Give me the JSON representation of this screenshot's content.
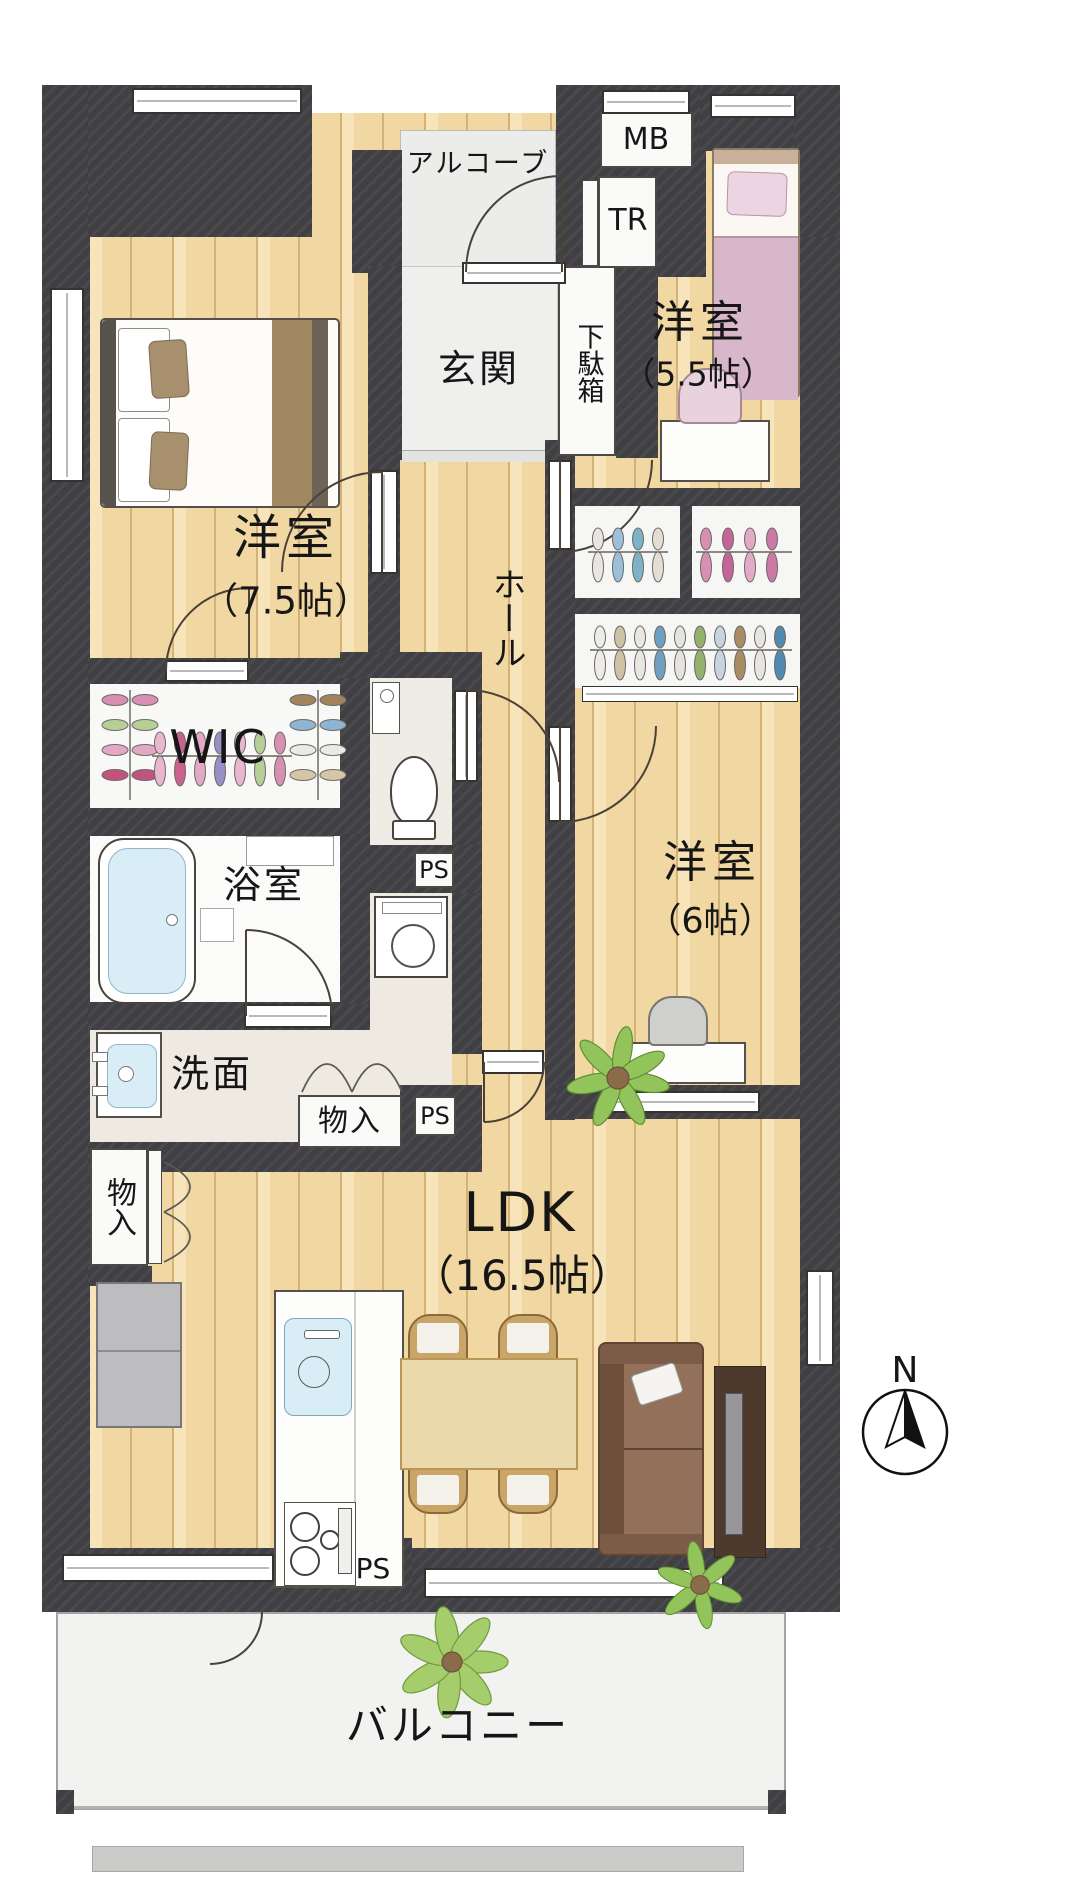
{
  "rooms": {
    "alcove": {
      "label": "アルコーブ"
    },
    "meter_box": {
      "label": "MB"
    },
    "trunk_room": {
      "label": "TR"
    },
    "entrance": {
      "label": "玄関"
    },
    "shoe_cabinet": {
      "label": "下駄箱"
    },
    "bedroom_75": {
      "label": "洋室",
      "size": "（7.5帖）"
    },
    "bedroom_55": {
      "label": "洋室",
      "size": "（5.5帖）"
    },
    "bedroom_6": {
      "label": "洋室",
      "size": "（6帖）"
    },
    "hall": {
      "label": "ホール"
    },
    "wic": {
      "label": "WIC"
    },
    "bathroom": {
      "label": "浴室"
    },
    "washroom": {
      "label": "洗面"
    },
    "storage": {
      "label": "物入"
    },
    "pipe_space": {
      "label": "PS"
    },
    "ldk": {
      "label": "LDK",
      "size": "（16.5帖）"
    },
    "balcony": {
      "label": "バルコニー"
    }
  },
  "compass": {
    "north_label": "N"
  },
  "colors": {
    "wall": "#403f43",
    "wood_floor": "#f1d7a2",
    "white_room": "#fafaf9",
    "vanity_beige": "#eeeae2",
    "water_blue": "#d9edf6",
    "bed_pink": "#d9b7cb",
    "plant_green": "#93c45c"
  }
}
